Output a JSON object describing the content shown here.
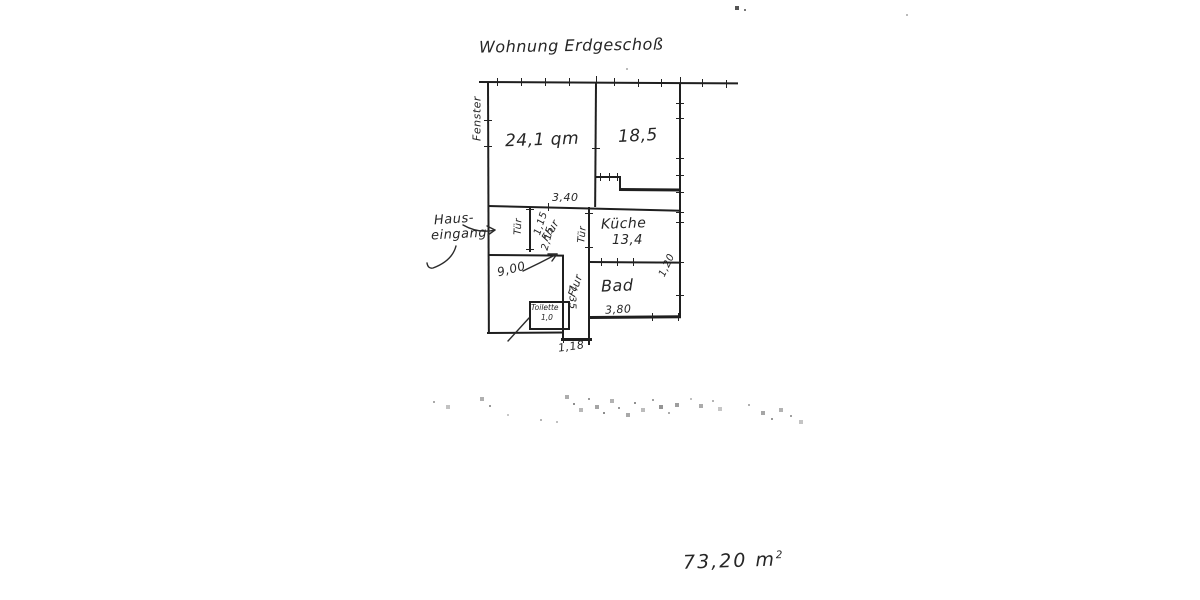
{
  "document": {
    "title": "Wohnung Erdgeschoß",
    "total_area": "73,20 m",
    "total_area_exponent": "2"
  },
  "annotations": {
    "window": "Fenster",
    "entrance_line1": "Haus-",
    "entrance_line2": "eingang"
  },
  "rooms": {
    "living": {
      "area": "24,1 qm"
    },
    "bedroom": {
      "area": "18,5"
    },
    "kitchen": {
      "name": "Küche",
      "area": "13,4"
    },
    "bathroom": {
      "name": "Bad"
    },
    "toilet": {
      "name": "Toilette",
      "area": "1,0"
    },
    "hallway_upper": {
      "name": "Flur"
    },
    "hallway_lower": {
      "name": "Flur"
    }
  },
  "doors": {
    "entry_hall_door": "Tür",
    "kitchen_door": "Tür"
  },
  "dimensions": {
    "hall_length": "3,40",
    "bath_width": "3,80",
    "hall_exit_width": "1,18",
    "lower_room_area": "9,00",
    "bath_side": "1,20",
    "hall_lower_length": "2,35",
    "door_width": "1,15",
    "hall_width": "2,15"
  }
}
